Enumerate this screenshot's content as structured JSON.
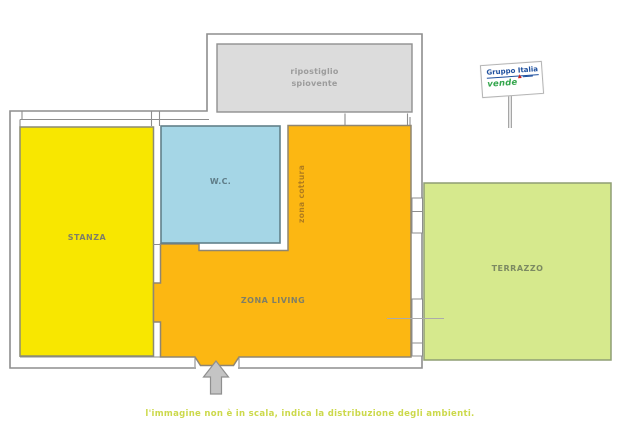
{
  "rooms": {
    "stanza": {
      "label": "STANZA",
      "color": "#f8e700"
    },
    "wc": {
      "label": "W.C.",
      "color": "#a5d6e6"
    },
    "living": {
      "label": "ZONA LIVING",
      "color": "#fcb712"
    },
    "cottura": {
      "label": "zona cottura"
    },
    "ripostiglio": {
      "label_line1": "ripostiglio",
      "label_line2": "spiovente",
      "color": "#dcdcdc"
    },
    "terrazzo": {
      "label": "TERRAZZO",
      "color": "#d6e98d"
    }
  },
  "sign": {
    "brand_line1": "Gruppo Italia",
    "brand_line2": "vende",
    "triangle_icon": "▲",
    "colors": {
      "blue": "#1d4f9e",
      "green": "#33a64c",
      "red": "#cc2222"
    }
  },
  "entrance": {
    "arrow_icon": "up-arrow",
    "color": "#c4c4c4"
  },
  "caption": {
    "text": "l'immagine non è in scala, indica la distribuzione degli ambienti.",
    "color": "#ccd94b"
  },
  "wall_color": "#8e8e8e"
}
